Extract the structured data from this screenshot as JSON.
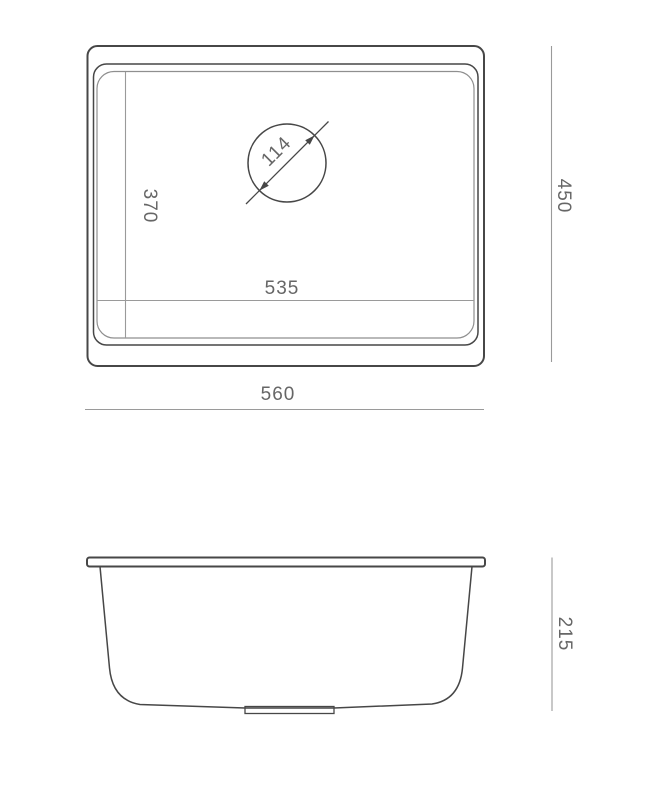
{
  "drawing": {
    "title": "sink-dimension-drawing",
    "background": "#ffffff",
    "outline_color": "#474747",
    "secondary_line_color": "#8f8f8f",
    "dimension_line_color": "#9a9a9a",
    "text_color": "#666666"
  },
  "views": {
    "top": {
      "name": "sink-top-view",
      "dimensions": {
        "overall_width": "560",
        "overall_depth": "450",
        "bowl_width": "535",
        "bowl_depth": "370",
        "drain_diameter": "114"
      }
    },
    "side": {
      "name": "sink-side-view",
      "dimensions": {
        "bowl_height": "215"
      }
    }
  }
}
